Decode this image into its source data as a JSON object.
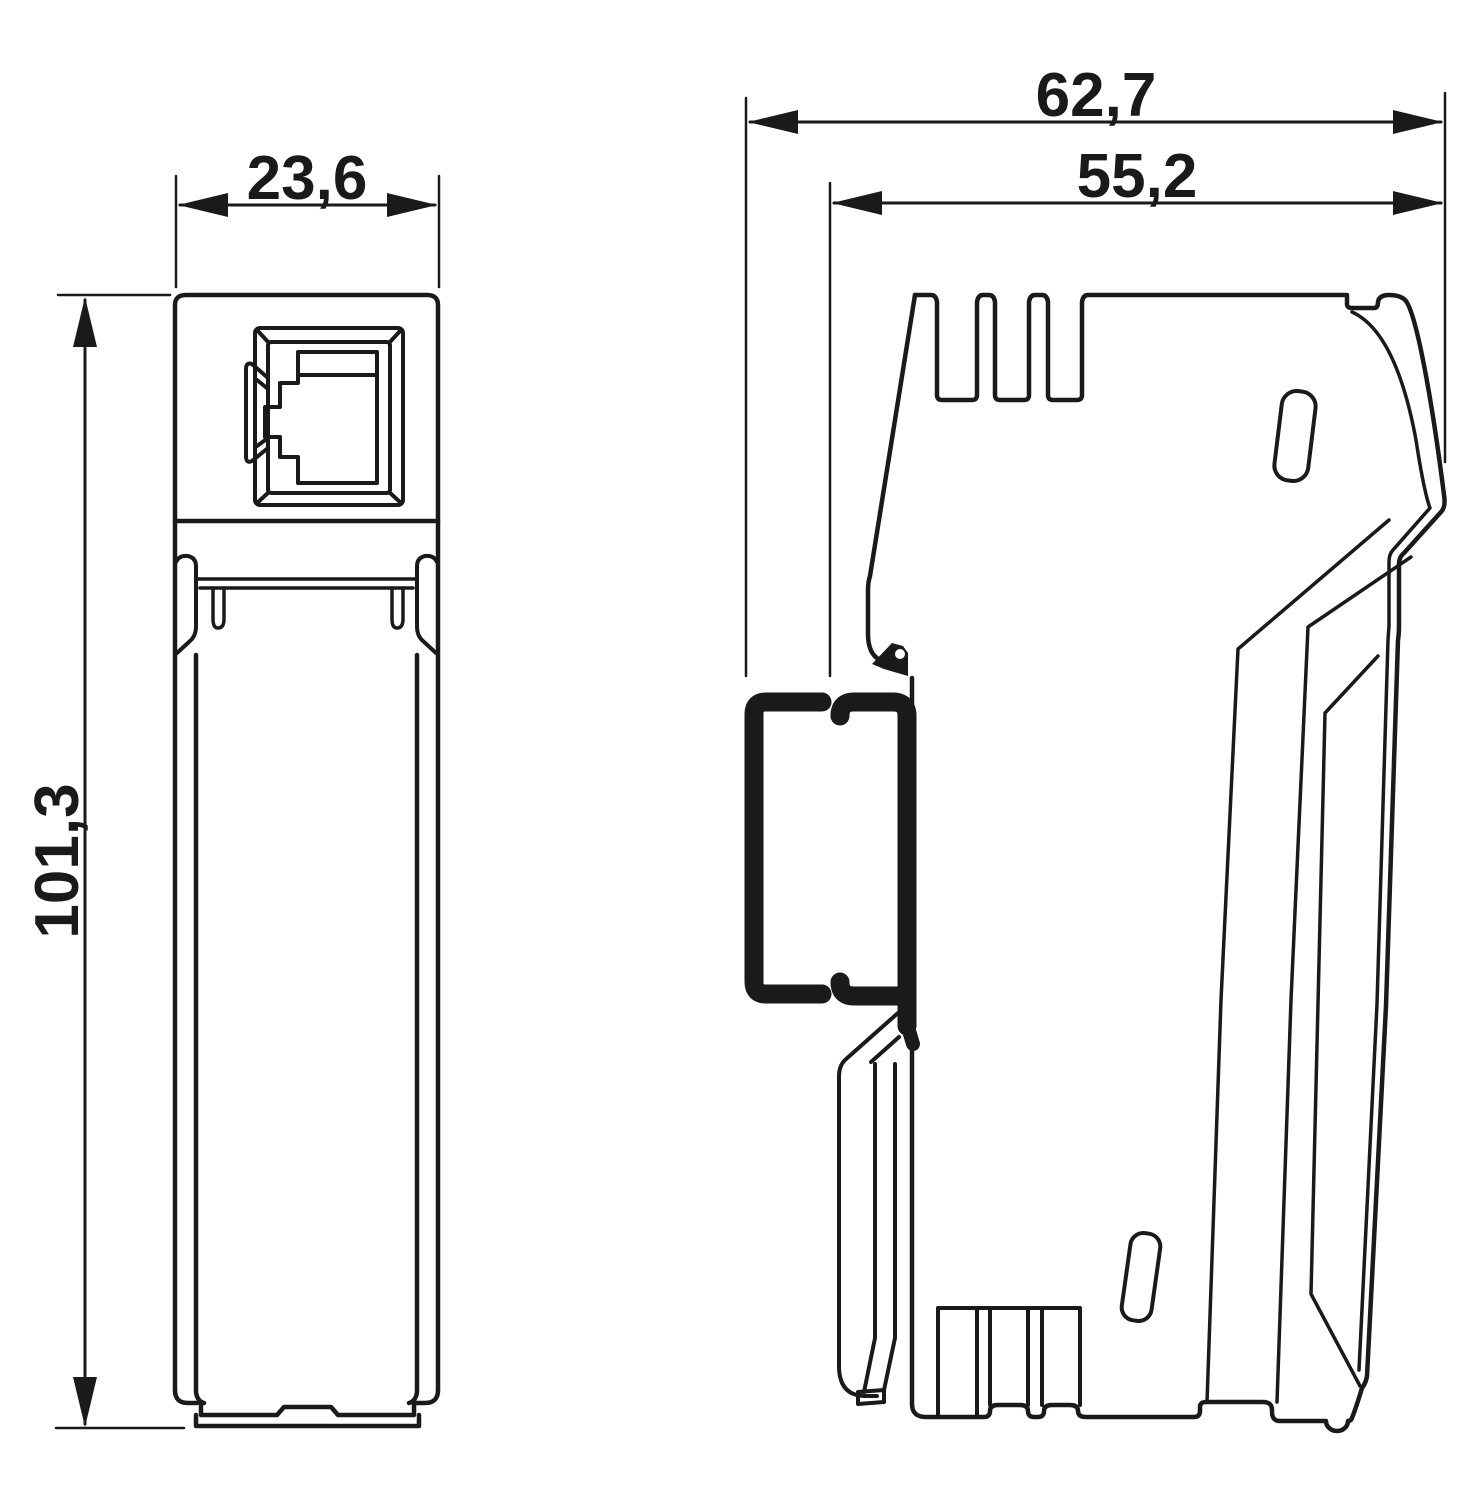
{
  "drawing": {
    "views": {
      "front": {
        "width": "23,6",
        "height": "101,3"
      },
      "side": {
        "depth_total": "62,7",
        "depth_housing": "55,2"
      }
    },
    "colors": {
      "line": "#1a1a1a",
      "background": "#ffffff"
    }
  }
}
